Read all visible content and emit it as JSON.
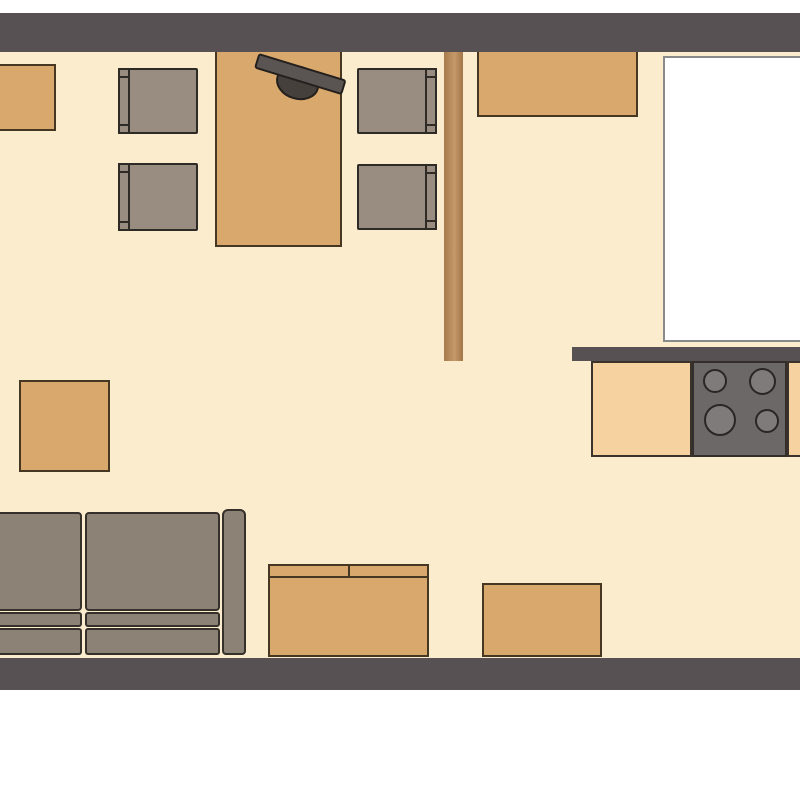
{
  "meta": {
    "app_type": "2d-floor-plan",
    "view": "top-down",
    "visible_text": "",
    "scene": "Open-plan studio: dining area top-left, kitchen on the right, living area along the bottom wall"
  },
  "palette": {
    "outside": "#ffffff",
    "wall": "#585153",
    "floor": "#fbeccd",
    "wood_furniture_fill": "#d9a86c",
    "wood_furniture_outline": "#453722",
    "kitchen_counter_fill": "#f5d2a0",
    "upholstery_fill": "#8d8276",
    "chair_fill": "#988d80",
    "upholstery_outline": "#2e2a25",
    "stove_fill": "#6b6867",
    "burner_fill": "#7e7b7a",
    "wood_divider": "#b78b5c",
    "white_unit_fill": "#ffffff",
    "white_unit_border": "#8a8a8a",
    "tv_fill": "#5a5552"
  },
  "walls": [
    {
      "id": "wall-top",
      "side": "top",
      "full_width": true
    },
    {
      "id": "wall-bottom",
      "side": "bottom",
      "full_width": true
    },
    {
      "id": "wall-kitchen",
      "side": "interior",
      "note": "short wall segment above kitchen counter, right side"
    }
  ],
  "furniture": [
    {
      "id": "cab-topleft",
      "label": "small cabinet",
      "zone": "top-left, against top wall",
      "cut_off": "left edge"
    },
    {
      "id": "dining-table",
      "label": "dining table",
      "zone": "dining area, against top wall"
    },
    {
      "id": "tv",
      "label": "television on table",
      "zone": "on dining table, rotated ~17°"
    },
    {
      "id": "chair-1",
      "label": "dining chair facing right",
      "zone": "left of table, upper"
    },
    {
      "id": "chair-2",
      "label": "dining chair facing right",
      "zone": "left of table, lower"
    },
    {
      "id": "chair-3",
      "label": "dining chair facing left",
      "zone": "right of table, upper"
    },
    {
      "id": "chair-4",
      "label": "dining chair facing left",
      "zone": "right of table, lower"
    },
    {
      "id": "divider",
      "label": "wooden room divider / partition",
      "zone": "centre, from top wall downward"
    },
    {
      "id": "sideboard-top",
      "label": "sideboard",
      "zone": "top centre-right, against top wall"
    },
    {
      "id": "white-unit",
      "label": "large white unit (appliance / island)",
      "zone": "top-right corner",
      "cut_off": "right edge"
    },
    {
      "id": "counter-left",
      "label": "kitchen counter section",
      "zone": "kitchen, below interior wall"
    },
    {
      "id": "stove",
      "label": "cooktop with 4 burners",
      "zone": "kitchen counter, right",
      "burners": 4
    },
    {
      "id": "counter-right",
      "label": "kitchen counter section",
      "zone": "kitchen, right edge",
      "cut_off": "right edge"
    },
    {
      "id": "side-table",
      "label": "square side table",
      "zone": "mid-left"
    },
    {
      "id": "sofa",
      "label": "sofa with two cushions and right armrest",
      "zone": "bottom-left, against bottom wall",
      "cut_off": "left edge"
    },
    {
      "id": "media-cabinet",
      "label": "media cabinet / sideboard with two doors",
      "zone": "bottom centre, against bottom wall"
    },
    {
      "id": "cab-bottomright",
      "label": "low cabinet",
      "zone": "bottom centre-right, against bottom wall"
    }
  ]
}
